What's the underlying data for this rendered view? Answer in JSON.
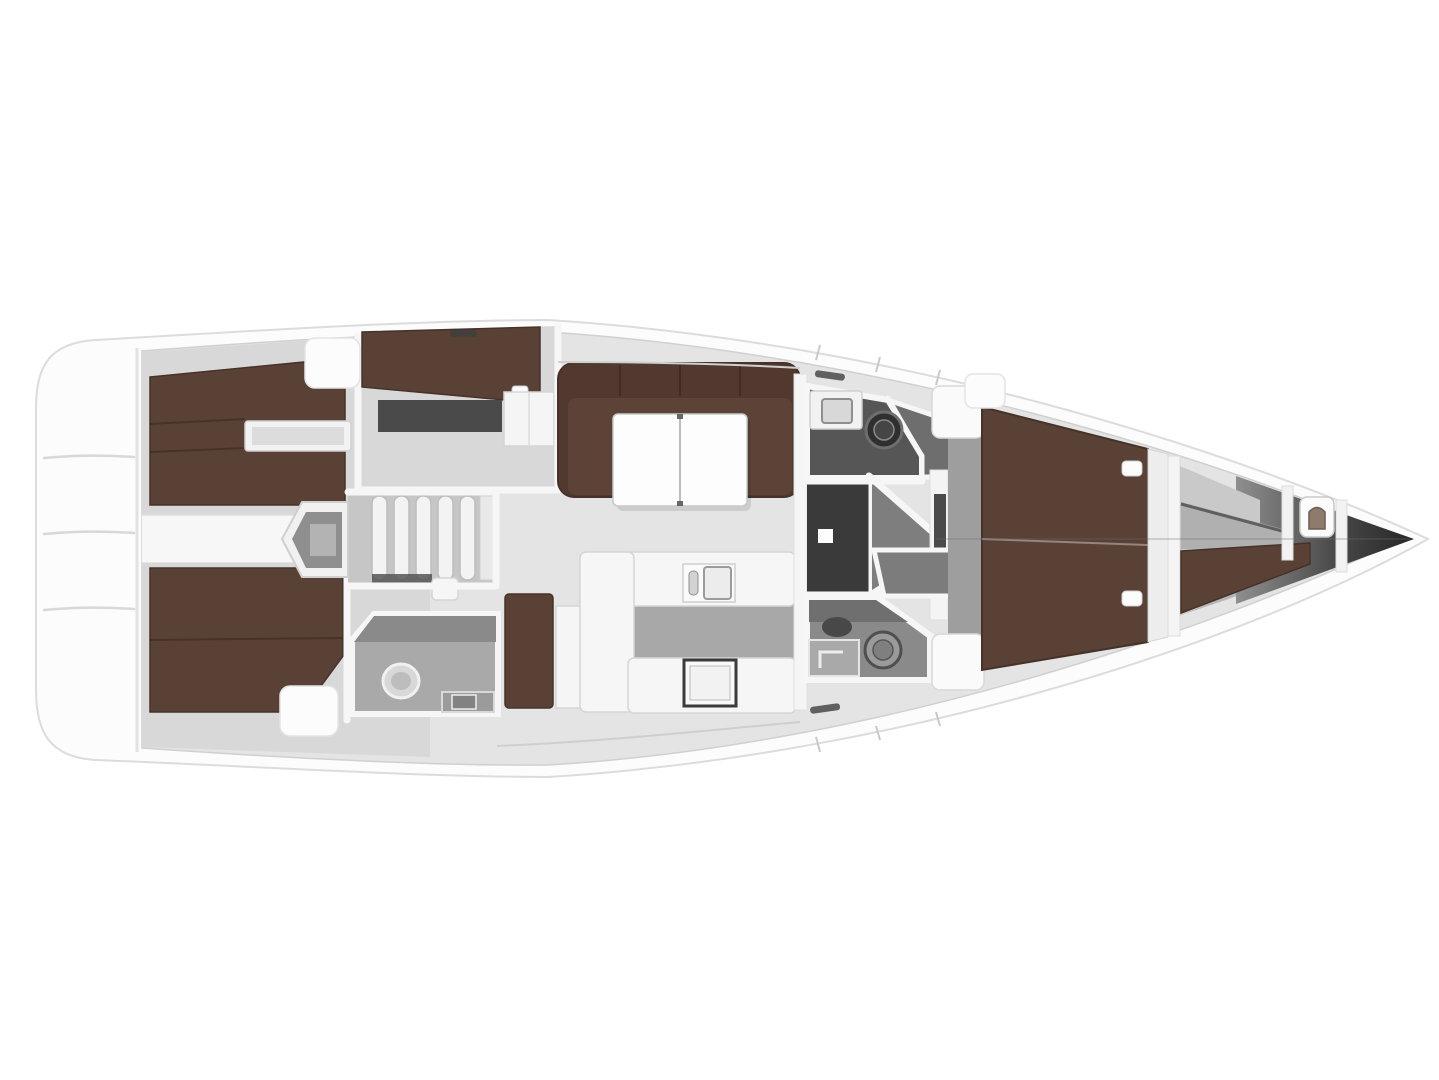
{
  "canvas": {
    "width": 1439,
    "height": 1080
  },
  "scene": {
    "name": "sailing-yacht-interior-floor-plan",
    "view": "top-down deck layout rendering",
    "regions": [
      "hull",
      "swim-platform",
      "aft-cabin-port",
      "aft-cabin-starboard",
      "bunk-cabin",
      "walkway",
      "engine-compartment",
      "companionway-steps",
      "aft-head",
      "nav-station",
      "salon",
      "salon-settee",
      "salon-table",
      "galley",
      "galley-sink",
      "galley-stove",
      "head-port",
      "head-starboard",
      "shower-port",
      "shower-starboard",
      "corridor",
      "owner-cabin",
      "owner-berth",
      "fore-cabin",
      "crew-berth",
      "bow-locker",
      "bow-tip"
    ]
  },
  "colors": {
    "background": "#ffffff",
    "hull": "#fcfcfc",
    "hull_outline": "#dcdcdc",
    "interior_floor": "#e4e4e4",
    "cabin_floor": "#d8d8d8",
    "walkway": "#f7f7f7",
    "berth_brown": "#5a4136",
    "berth_edge": "#463228",
    "settee_back": "#52392f",
    "settee_seat": "#5d4337",
    "table_white": "#fdfdfd",
    "furniture_white": "#f5f5f5",
    "furniture_outline": "#d5d5d5",
    "counter_white": "#f6f6f6",
    "galley_floor": "#a8a8a8",
    "stove_frame": "#3a3a3a",
    "aft_head_floor": "#a9a9a9",
    "head_floor": "#565656",
    "head_floor_light": "#8a8a8a",
    "shower_floor": "#6e6e6e",
    "shower_floor_light": "#7c7c7c",
    "corridor_dark": "#3a3a3a",
    "vestibule": "#7e7e7e",
    "locker_dark": "#4a4a4a",
    "engine_gray": "#8f8f8f",
    "steps_base": "#c6c6c6",
    "step_tread": "#f3f3f3",
    "owner_floor": "#9e9e9e",
    "shelf_gray": "#b0b0b0",
    "fore_floor": "#c9c9c9",
    "toilet_dark": "#2f2f2f",
    "toilet_light": "#d8d8d8"
  }
}
